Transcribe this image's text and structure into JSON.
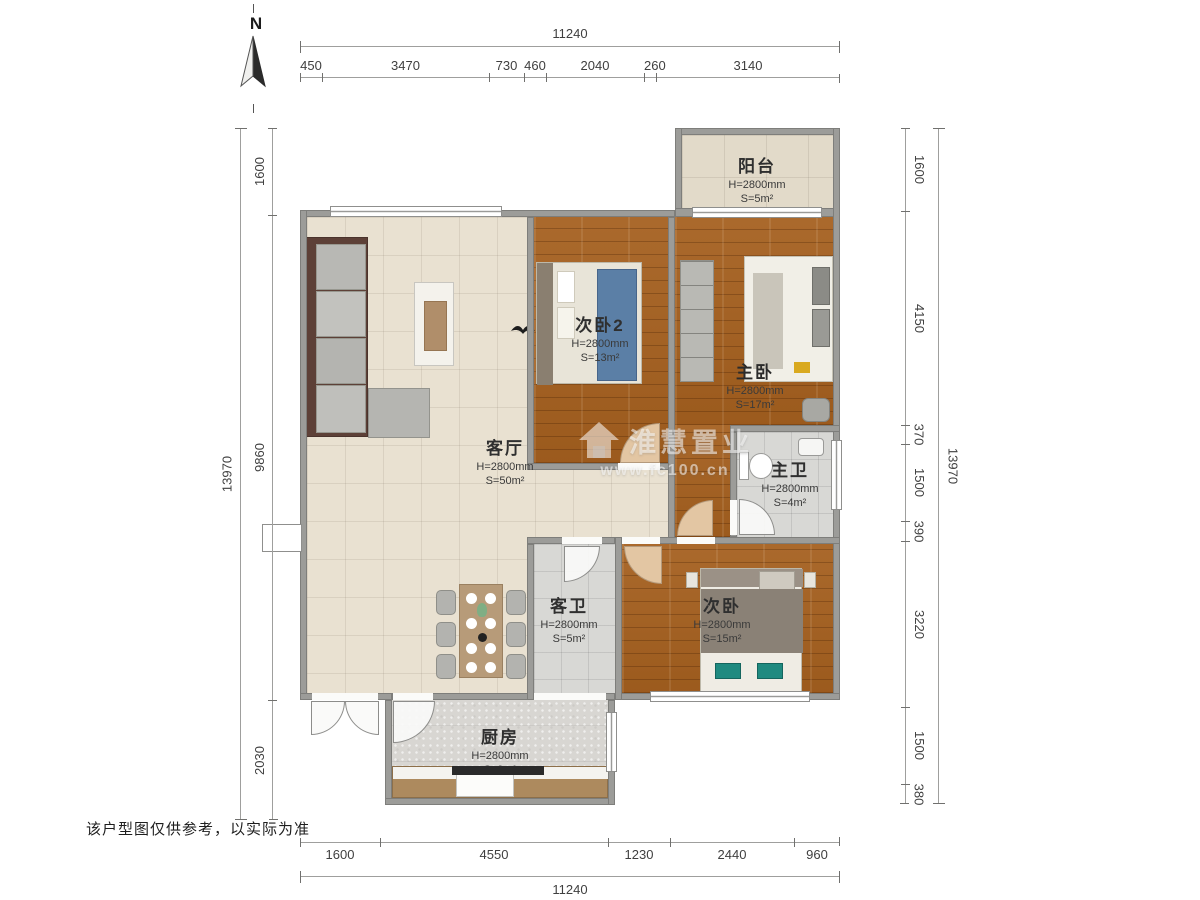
{
  "north": {
    "label": "N"
  },
  "disclaimer": "该户型图仅供参考，以实际为准",
  "watermark": {
    "brand_cjk": "淮慧置业",
    "url": "www.fc100.cn"
  },
  "rooms": [
    {
      "key": "balcony",
      "name": "阳台",
      "ceiling": "H=2800mm",
      "area": "S=5m²"
    },
    {
      "key": "bedroom2",
      "name": "次卧2",
      "ceiling": "H=2800mm",
      "area": "S=13m²"
    },
    {
      "key": "master-bedroom",
      "name": "主卧",
      "ceiling": "H=2800mm",
      "area": "S=17m²"
    },
    {
      "key": "living-room",
      "name": "客厅",
      "ceiling": "H=2800mm",
      "area": "S=50m²"
    },
    {
      "key": "master-bath",
      "name": "主卫",
      "ceiling": "H=2800mm",
      "area": "S=4m²"
    },
    {
      "key": "guest-bath",
      "name": "客卫",
      "ceiling": "H=2800mm",
      "area": "S=5m²"
    },
    {
      "key": "bedroom",
      "name": "次卧",
      "ceiling": "H=2800mm",
      "area": "S=15m²"
    },
    {
      "key": "kitchen",
      "name": "厨房",
      "ceiling": "H=2800mm",
      "area": "S=9m²"
    }
  ],
  "dimensions": {
    "top": {
      "total": "11240",
      "segments": [
        "450",
        "3470",
        "730",
        "460",
        "2040",
        "260",
        "3140"
      ]
    },
    "bottom": {
      "total": "11240",
      "segments": [
        "1600",
        "4550",
        "1230",
        "2440",
        "960"
      ]
    },
    "left": {
      "total": "13970",
      "segments": [
        "1600",
        "9860",
        "2030"
      ]
    },
    "right": {
      "total": "13970",
      "segments": [
        "1600",
        "4150",
        "370",
        "1500",
        "390",
        "3220",
        "1500",
        "380"
      ]
    }
  },
  "colors": {
    "wood": "#a5601f",
    "living_tile": "#e9e1d1",
    "bath_tile": "#d8d8d5",
    "wall": "#9c9c99",
    "door_swing": "#e3c6a3",
    "accent_teal": "#1f8a80",
    "accent_blue": "#5b7fa6"
  }
}
